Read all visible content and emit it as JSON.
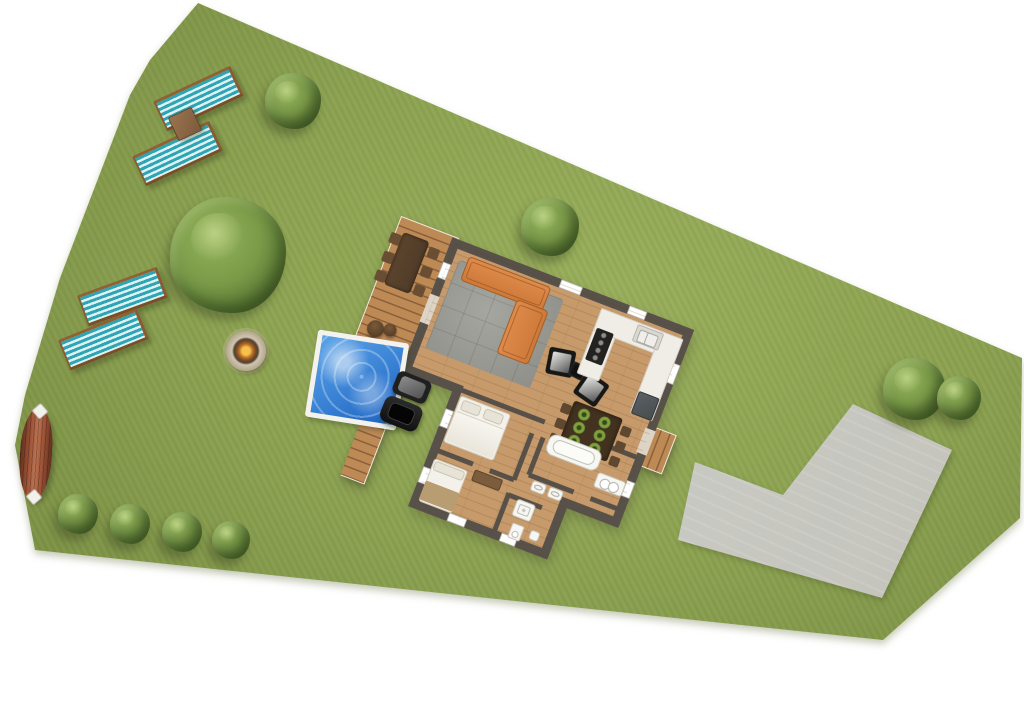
{
  "scene": {
    "title": "Top-down site plan of a holiday home with garden",
    "kind": "3d-rendered floor / site plan",
    "text_content": "none — image contains no visible text"
  },
  "colors": {
    "white": "#ffffff",
    "grass": "#8ba150",
    "grassLight": "#99ae5b",
    "grassDark": "#75893f",
    "concrete": "#cbcbc5",
    "concreteLight": "#d6d6d0",
    "wall": "#57514a",
    "floor": "#c69a6a",
    "deck": "#bd8a55",
    "deckGap": "#8a5f3a",
    "deckTrim": "#f1e9dc",
    "rug": "#9a9a94",
    "sofa": "#cd7939",
    "counter": "#f0ede6",
    "appliance": "#23221f",
    "steel": "#d9d8d2",
    "fridge": "#484d50",
    "tableWood": "#43321f",
    "plate": "#7fa03f",
    "chairWood": "#5f4730",
    "bedding": "#f3f1ea",
    "pillow": "#e7e3d6",
    "blanket": "#b99d72",
    "fixture": "#f6f6f2",
    "poolFrame": "#f3f2ee",
    "poolWater1": "#5aa3e8",
    "poolWater2": "#1d64c3",
    "loungerTeal": "#2fa4b4",
    "loungerWhite": "#ddf2f3",
    "loungerWood": "#8a5a33",
    "treeLight": "#93b25c",
    "treeMid": "#7a9a48",
    "treeDark": "#4c682c",
    "fire": "#f6c14a",
    "ember": "#b96a25",
    "stone": "#cfc5b2",
    "boatHull": "#8f4a2f"
  },
  "rooms": [
    "living-room",
    "kitchen",
    "dining-area",
    "bedroom-1",
    "bedroom-2",
    "bathroom",
    "utility-hall",
    "wc"
  ],
  "garden_objects": [
    "deck",
    "outdoor-dining-set",
    "wicker-chairs",
    "swimming-pool",
    "bbq-grill",
    "fire-pit",
    "canoe",
    "sun-loungers",
    "driveway",
    "trees",
    "bushes"
  ],
  "vegetation": {
    "trees": [
      {
        "x": 228,
        "y": 255,
        "size": 116
      },
      {
        "x": 293,
        "y": 101,
        "size": 56
      },
      {
        "x": 550,
        "y": 227,
        "size": 58
      },
      {
        "x": 914,
        "y": 389,
        "size": 62
      },
      {
        "x": 959,
        "y": 398,
        "size": 44
      }
    ],
    "bushes": [
      {
        "x": 78,
        "y": 514,
        "size": 40
      },
      {
        "x": 130,
        "y": 524,
        "size": 40
      },
      {
        "x": 182,
        "y": 532,
        "size": 40
      },
      {
        "x": 231,
        "y": 540,
        "size": 38
      }
    ]
  },
  "loungers": {
    "items": [
      {
        "x": 196,
        "y": 95,
        "angle": -25
      },
      {
        "x": 175,
        "y": 150,
        "angle": -25
      },
      {
        "x": 120,
        "y": 293,
        "angle": -20
      },
      {
        "x": 101,
        "y": 336,
        "angle": -22
      }
    ],
    "table": {
      "x": 184,
      "y": 123,
      "angle": -25
    }
  }
}
